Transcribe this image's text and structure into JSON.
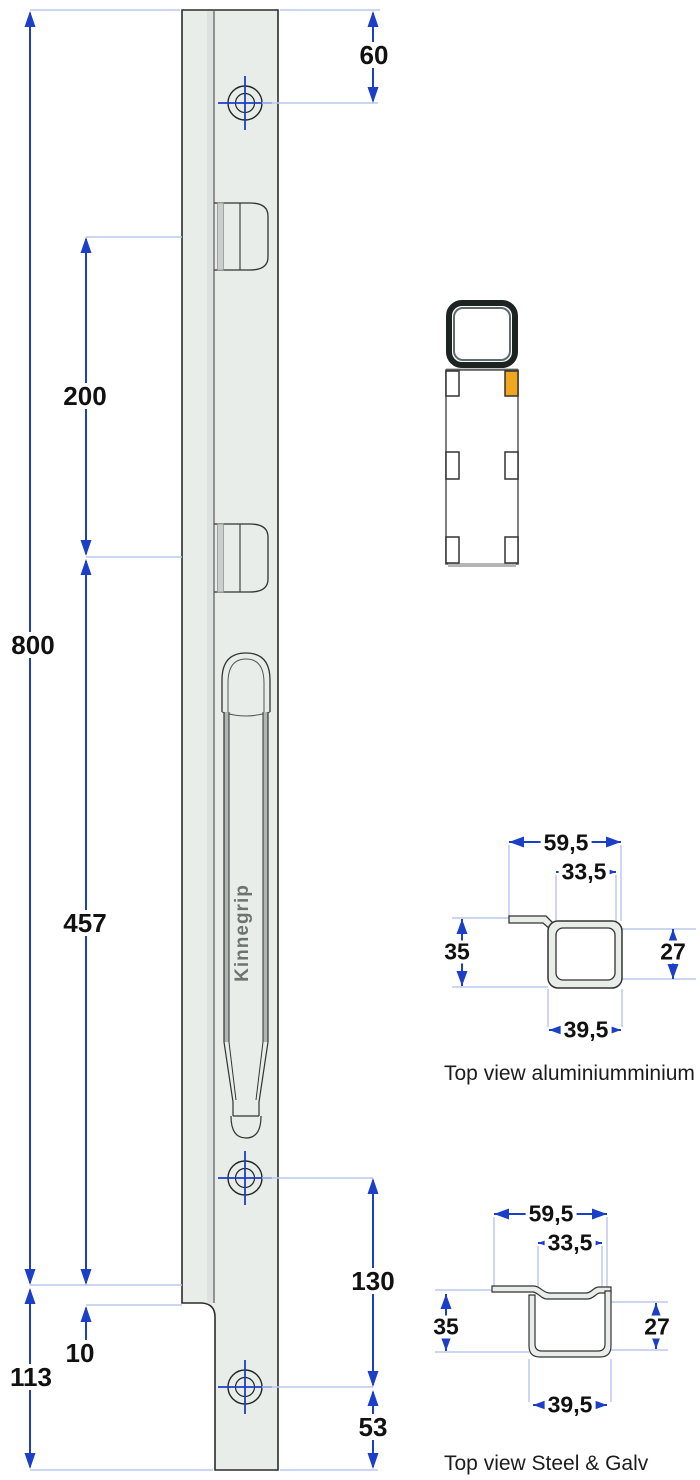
{
  "drawing": {
    "brand_label": "Kinnegrip",
    "dims": {
      "total_length": "800",
      "keeper_spacing": "200",
      "handle_section": "457",
      "bottom_section": "113",
      "step": "10",
      "top_hole_offset": "60",
      "hole_spacing": "130",
      "bottom_hole_offset": "53"
    },
    "alu_section": {
      "caption": "Top view aluminiumminium",
      "overall_width": "59,5",
      "inner_width": "33,5",
      "left_height": "35",
      "right_height": "27",
      "tube_width": "39,5"
    },
    "steel_section": {
      "caption": "Top view Steel & Galv",
      "overall_width": "59,5",
      "inner_width": "33,5",
      "left_height": "35",
      "right_height": "27",
      "tube_width": "39,5"
    },
    "colors": {
      "dimension_blue": "#1b3fc6",
      "extension_light_blue": "#bcc8ee",
      "body_fill": "#e8edea",
      "outline_dark": "#2b2b2b",
      "highlight_orange": "#f0a71f"
    }
  }
}
